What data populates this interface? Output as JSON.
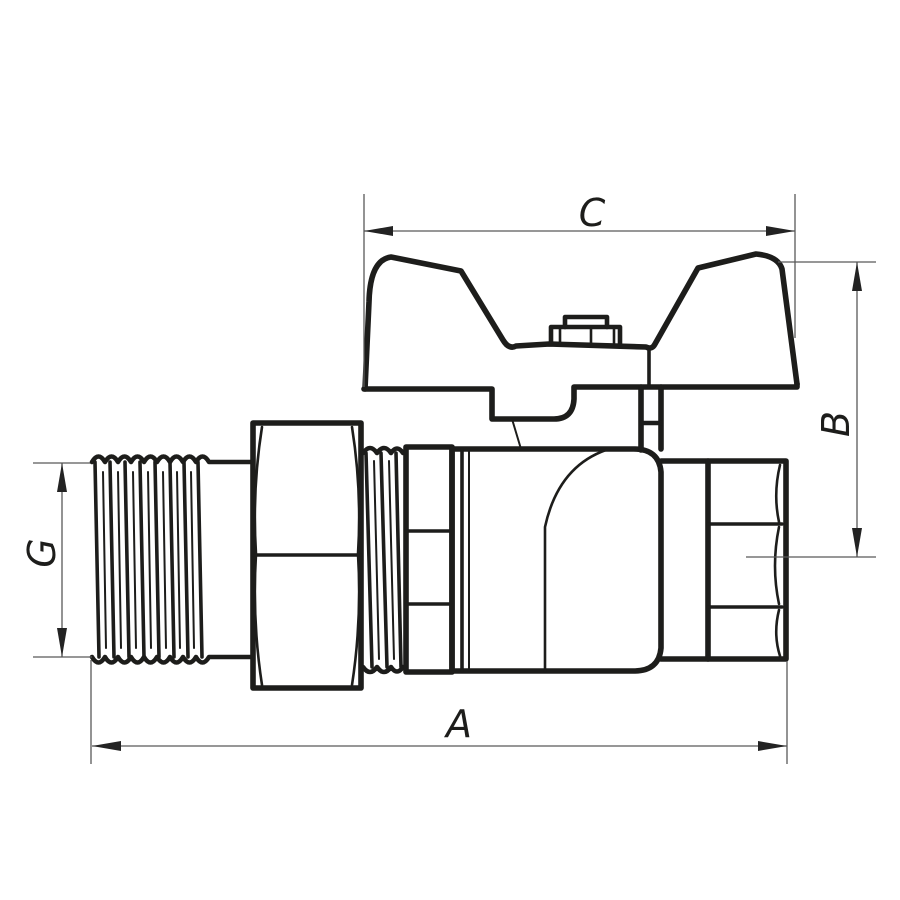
{
  "colors": {
    "bg": "#ffffff",
    "line": "#1d1d1b",
    "dim": "#595959",
    "arrow": "#232323"
  },
  "drawing": {
    "kind": "technical-line-drawing",
    "subject": "ball valve with butterfly handle, union nut, male threaded inlet and female hex outlet",
    "dimensions": {
      "c": {
        "label": "C",
        "orientation": "horizontal",
        "position": "top"
      },
      "b": {
        "label": "B",
        "orientation": "vertical",
        "position": "right"
      },
      "g": {
        "label": "G",
        "orientation": "vertical",
        "position": "left"
      },
      "a": {
        "label": "A",
        "orientation": "horizontal",
        "position": "bottom"
      }
    }
  }
}
